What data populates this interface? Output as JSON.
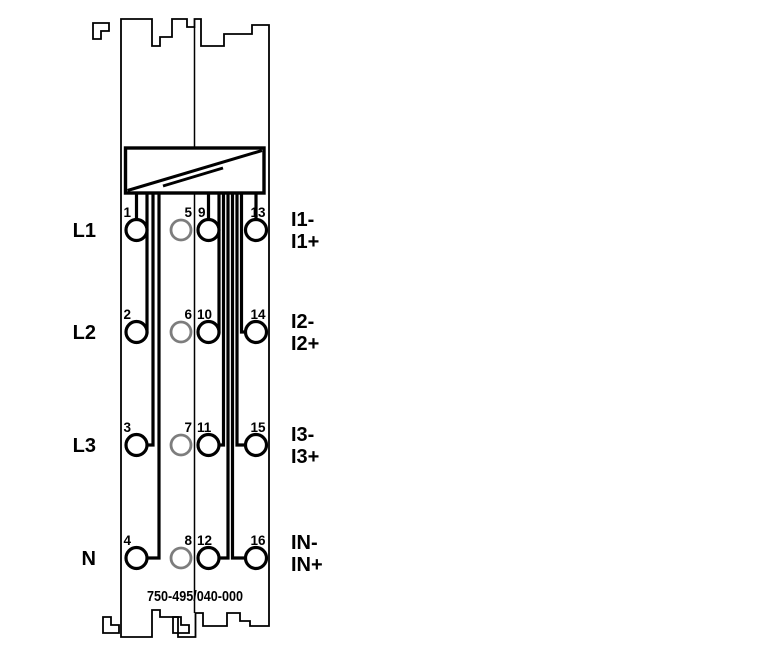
{
  "module": {
    "part_number": "750-495/040-000",
    "description": "terminal-module-wiring-diagram"
  },
  "labels": {
    "left": [
      "L1",
      "L2",
      "L3",
      "N"
    ],
    "right": [
      [
        "I1-",
        "I1+"
      ],
      [
        "I2-",
        "I2+"
      ],
      [
        "I3-",
        "I3+"
      ],
      [
        "IN-",
        "IN+"
      ]
    ]
  },
  "terminals": {
    "col1": [
      "1",
      "2",
      "3",
      "4"
    ],
    "col2": [
      "5",
      "6",
      "7",
      "8"
    ],
    "col3": [
      "9",
      "10",
      "11",
      "12"
    ],
    "col4": [
      "13",
      "14",
      "15",
      "16"
    ]
  },
  "colors": {
    "line": "#000000",
    "unconnected_terminal": "#7d7d7d",
    "background": "#ffffff"
  }
}
